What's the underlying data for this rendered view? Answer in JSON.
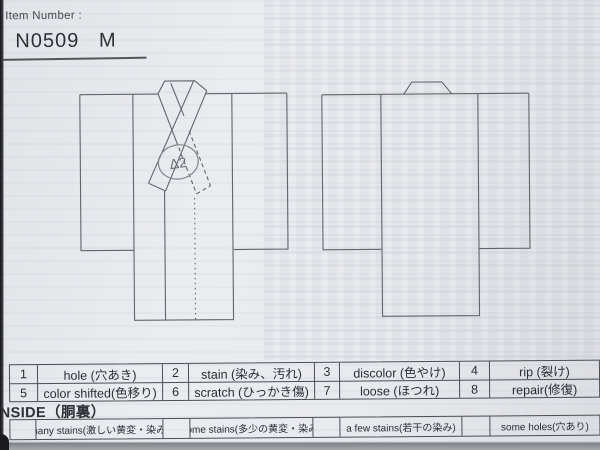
{
  "colors": {
    "paper": "#e9eaed",
    "ink": "#2e2f36",
    "diagram_line": "#63646b",
    "table_border": "#4c4d55",
    "pencil_annotation": "#85868f"
  },
  "header": {
    "label": "Item Number :",
    "value": "N0509   M"
  },
  "front_diagram": {
    "annotation": "Δ2"
  },
  "legend_table": {
    "rows": [
      {
        "cells": [
          {
            "num": "1",
            "label": "hole (穴あき)"
          },
          {
            "num": "2",
            "label": "stain (染み、汚れ)"
          },
          {
            "num": "3",
            "label": "discolor (色やけ)"
          },
          {
            "num": "4",
            "label": "rip (裂け)"
          }
        ]
      },
      {
        "cells": [
          {
            "num": "5",
            "label": "color shifted(色移り)"
          },
          {
            "num": "6",
            "label": "scratch (ひっかき傷)"
          },
          {
            "num": "7",
            "label": "loose (ほつれ)"
          },
          {
            "num": "8",
            "label": "repair(修復)"
          }
        ]
      }
    ]
  },
  "inside": {
    "title": "INSIDE（胴裏）",
    "options": [
      "many stains(激しい黄変・染み)",
      "some stains(多少の黄変・染み)",
      "a few stains(若干の染み)",
      "some holes(穴あり)"
    ]
  }
}
